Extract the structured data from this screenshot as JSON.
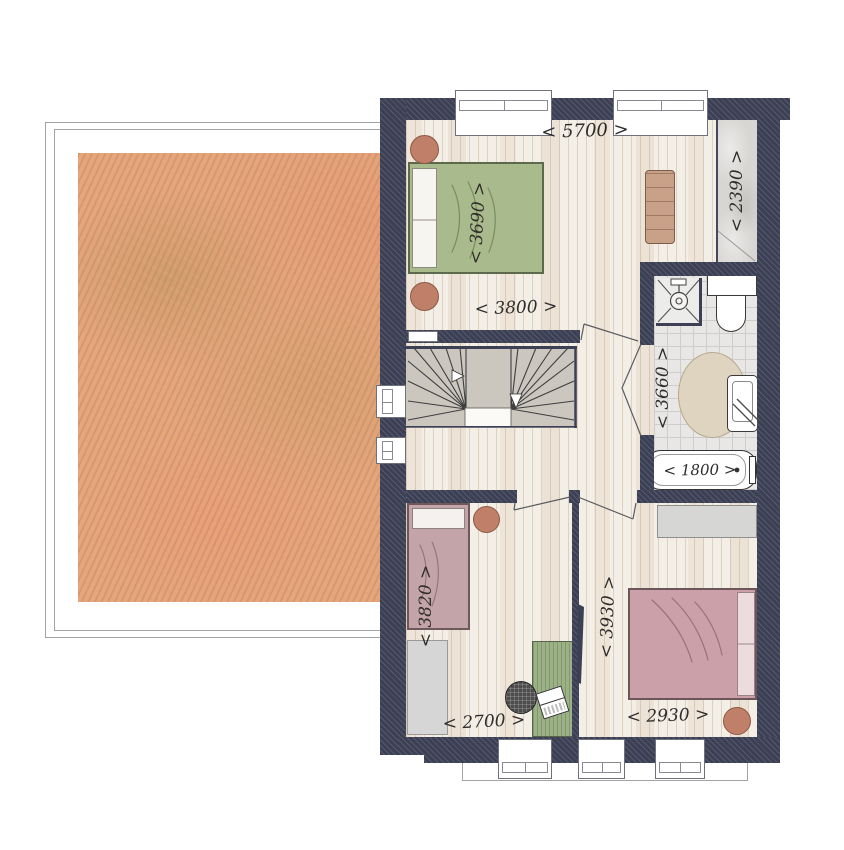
{
  "plan": {
    "kind": "first-floor plan",
    "dimensions": {
      "master_width": "< 5700 >",
      "wardrobe_length": "< 2390 >",
      "master_bed_side": "< 3690 >",
      "master_lower_width": "< 3800 >",
      "bathroom_length": "< 3660 >",
      "bathtub_length": "< 1800 >",
      "bedroom_left_length": "< 3820 >",
      "bedroom_right_length": "< 3930 >",
      "bedroom_left_width": "< 2700 >",
      "bedroom_right_width": "< 2930 >"
    },
    "fixtures": [
      "double-bed-green",
      "double-bed-pink",
      "single-bed-mauve",
      "bench",
      "wardrobe",
      "closet",
      "stairs",
      "shower",
      "toilet",
      "washbasin",
      "bathtub",
      "round-rug",
      "desk",
      "desk-chair",
      "laptop",
      "side-table",
      "stool",
      "rug",
      "roof-deck"
    ],
    "colors": {
      "wall": "#3c4054",
      "floor": "#f4efe6",
      "tiles": "#e8e7e5",
      "roof": "#e5a67e",
      "bed_green": "#a9ba8c",
      "bed_pink": "#cba0a9",
      "bed_mauve": "#c3a4a8",
      "terracotta": "#bf7f68",
      "desk_green": "#9cb286",
      "stairs": "#cbc7bf",
      "rug_beige": "#ded4c0",
      "wardrobe_grey": "#d7d6d3"
    }
  }
}
